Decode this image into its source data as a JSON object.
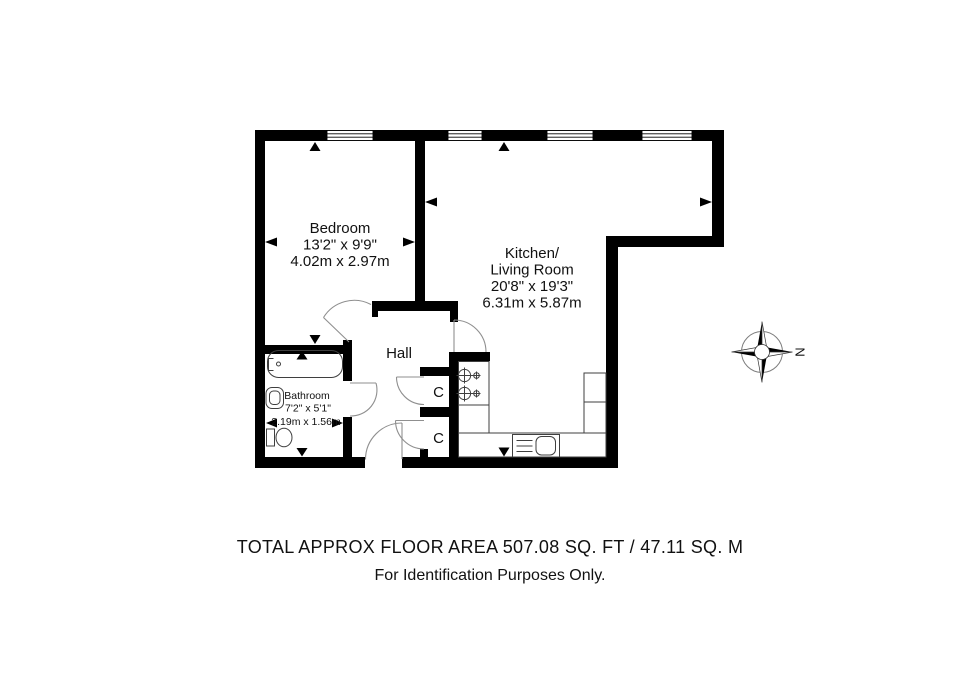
{
  "plan": {
    "rooms": {
      "bedroom": {
        "name": "Bedroom",
        "size_imperial": "13'2\" x 9'9\"",
        "size_metric": "4.02m x 2.97m"
      },
      "kitchen_living": {
        "name_line1": "Kitchen/",
        "name_line2": "Living Room",
        "size_imperial": "20'8\" x 19'3\"",
        "size_metric": "6.31m x 5.87m"
      },
      "bathroom": {
        "name": "Bathroom",
        "size_imperial": "7'2\" x 5'1\"",
        "size_metric": "2.19m x 1.56m"
      },
      "hall": {
        "name": "Hall"
      }
    },
    "closets": {
      "top": {
        "label": "C"
      },
      "bottom": {
        "label": "C"
      }
    },
    "compass": {
      "north_label": "N"
    },
    "colors": {
      "wall": "#000000",
      "fixture_line": "#3f3f3f",
      "door_arc": "#8f8f8f",
      "background": "#ffffff"
    }
  },
  "footer": {
    "area_line": "TOTAL APPROX FLOOR AREA 507.08 SQ. FT / 47.11 SQ. M",
    "disclaimer": "For Identification Purposes Only."
  }
}
